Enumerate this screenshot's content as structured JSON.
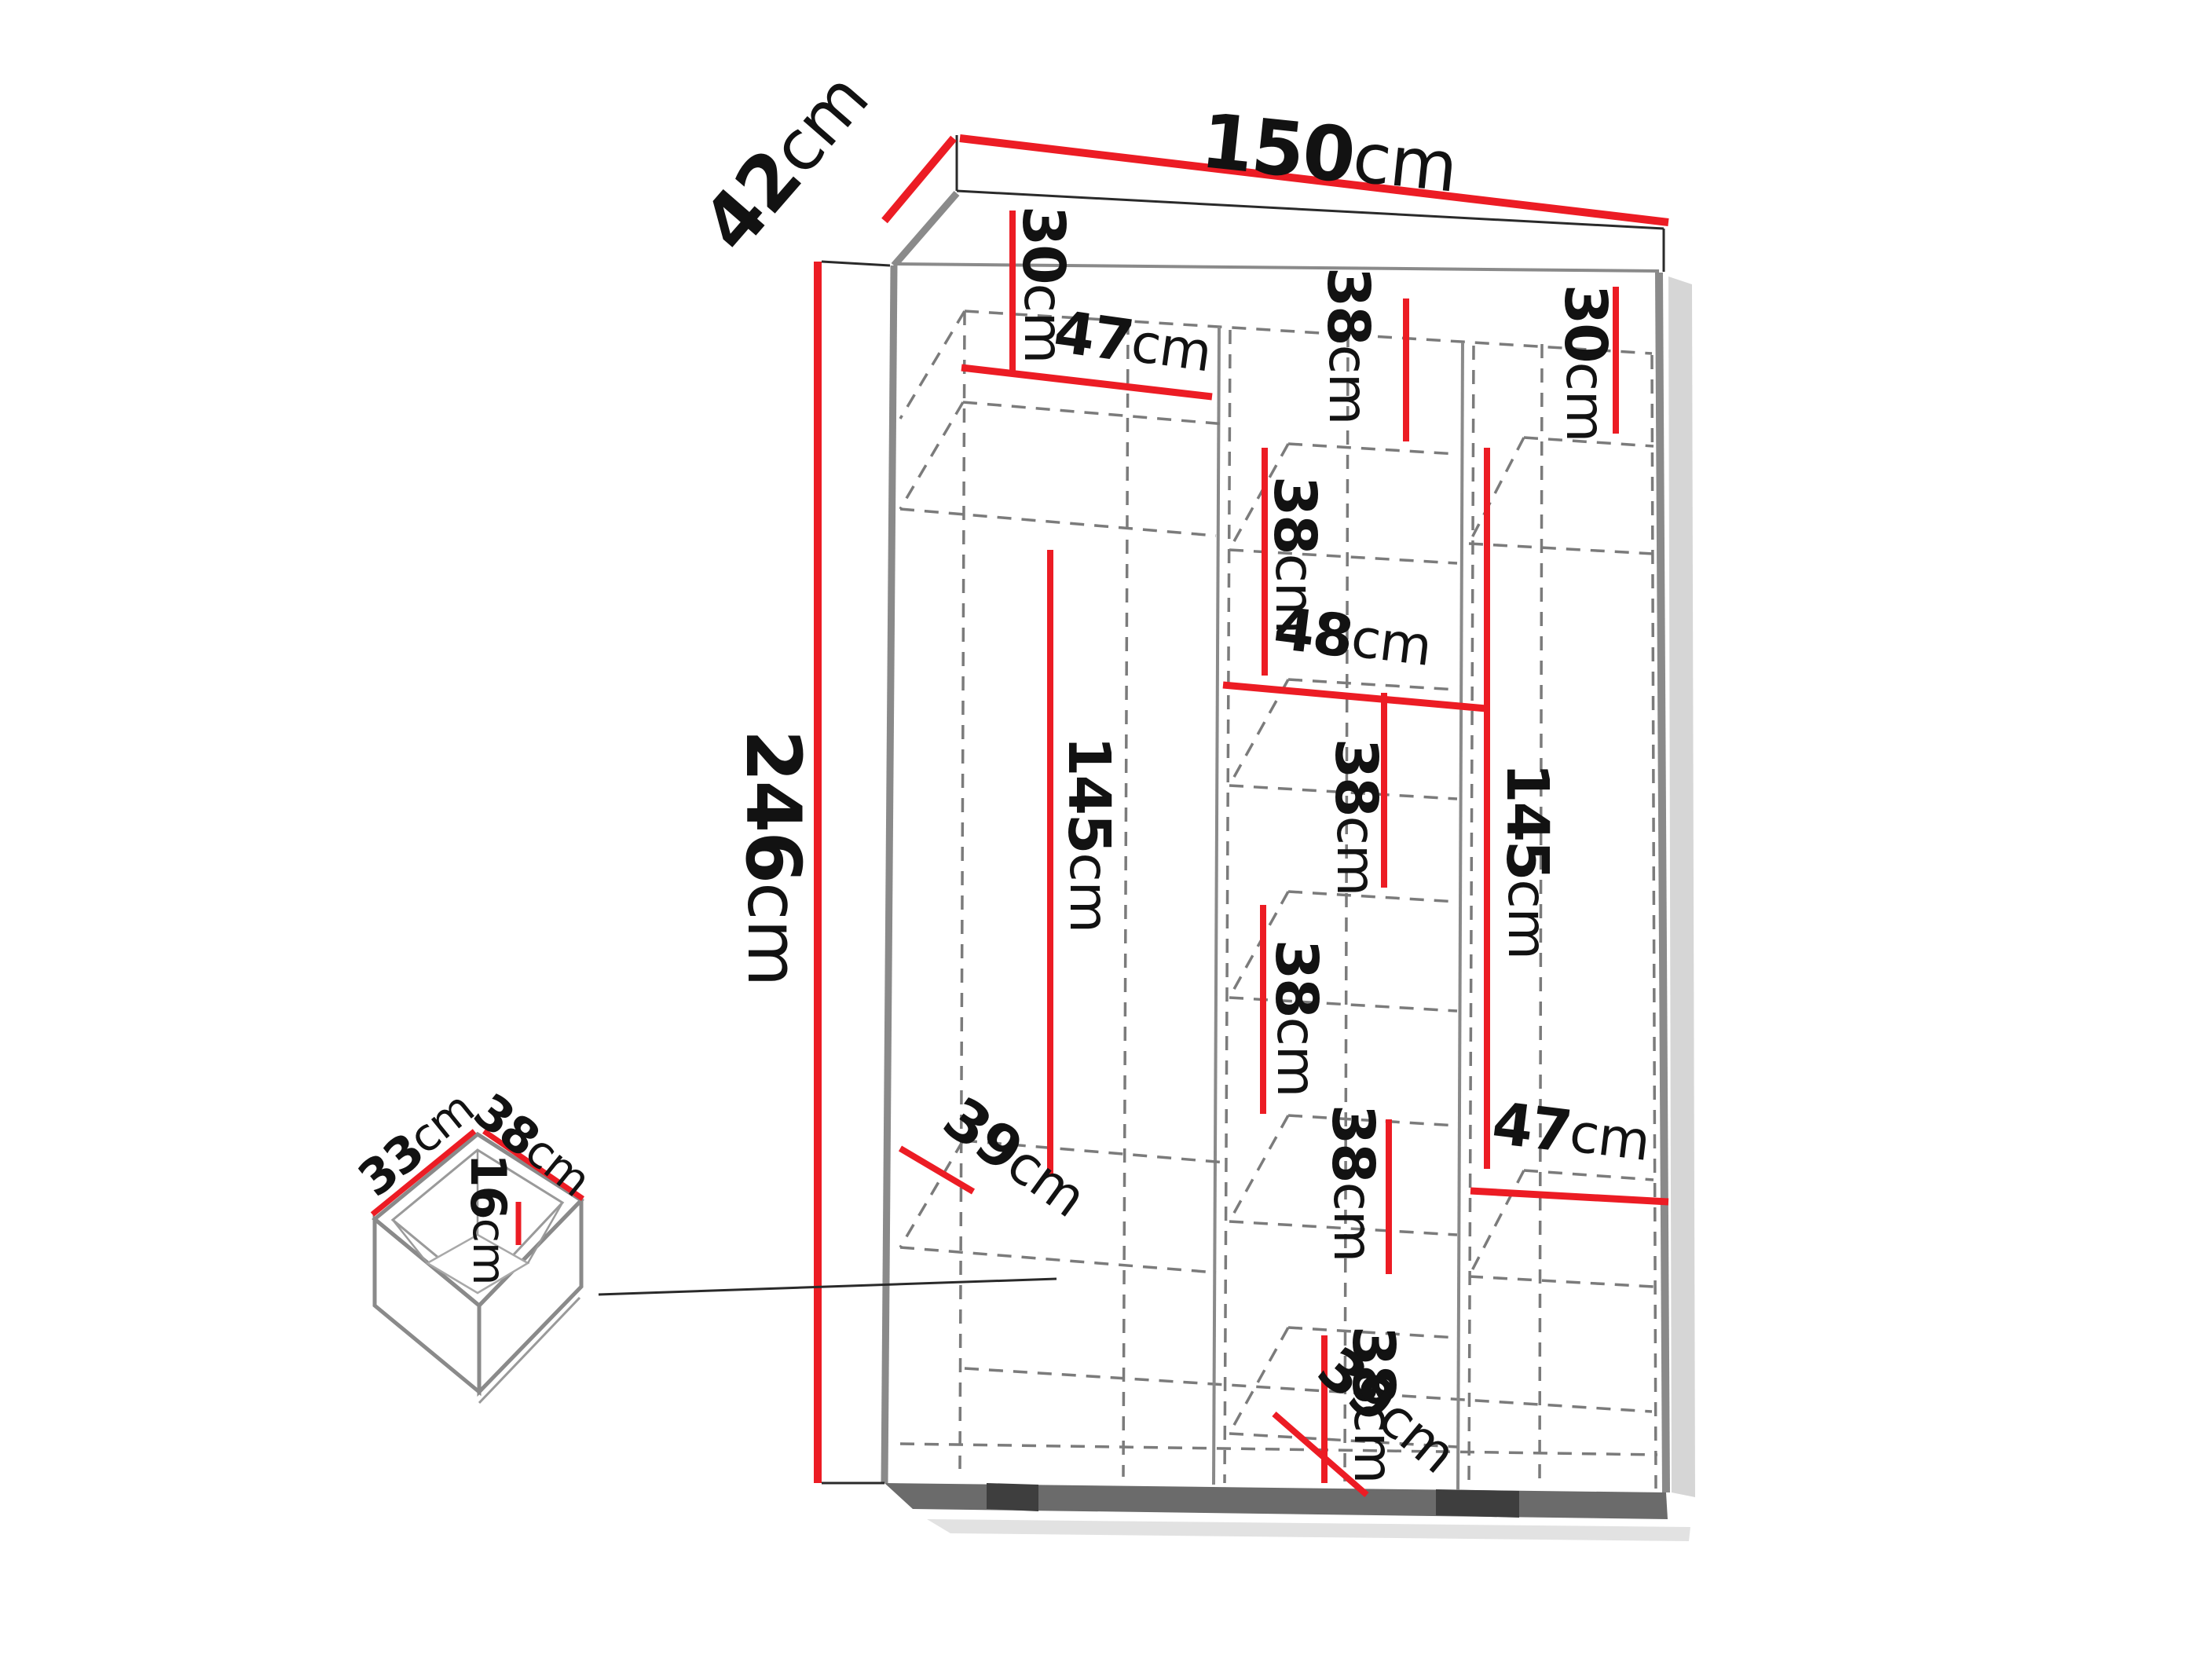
{
  "diagram": {
    "type": "furniture-dimension-diagram",
    "subject": "Three-section wardrobe wireframe with internal shelf dimensions and a detached drawer detail",
    "unit_system": "centimeters"
  },
  "colors": {
    "dimension_red": "#ec1c24",
    "structure_gray": "#8a8a8a",
    "dashed_gray": "#7b7b7b",
    "plinth_dark": "#636363",
    "text_black": "#121212",
    "background": "#ffffff"
  },
  "dims": [
    {
      "id": "top-width",
      "value": "150",
      "unit": "cm"
    },
    {
      "id": "top-depth",
      "value": "42",
      "unit": "cm"
    },
    {
      "id": "total-height",
      "value": "246",
      "unit": "cm"
    },
    {
      "id": "left-top-section-height",
      "value": "30",
      "unit": "cm"
    },
    {
      "id": "left-shelf-width",
      "value": "47",
      "unit": "cm"
    },
    {
      "id": "left-hanging-height",
      "value": "145",
      "unit": "cm"
    },
    {
      "id": "left-interior-depth",
      "value": "39",
      "unit": "cm"
    },
    {
      "id": "middle-section-1-height",
      "value": "38",
      "unit": "cm"
    },
    {
      "id": "middle-section-2-height",
      "value": "38",
      "unit": "cm"
    },
    {
      "id": "middle-shelf-width",
      "value": "48",
      "unit": "cm"
    },
    {
      "id": "middle-section-3-height",
      "value": "38",
      "unit": "cm"
    },
    {
      "id": "middle-section-4-height",
      "value": "38",
      "unit": "cm"
    },
    {
      "id": "middle-section-5-height",
      "value": "38",
      "unit": "cm"
    },
    {
      "id": "middle-section-6-height",
      "value": "38",
      "unit": "cm"
    },
    {
      "id": "middle-interior-depth",
      "value": "39",
      "unit": "cm"
    },
    {
      "id": "right-top-section-height",
      "value": "30",
      "unit": "cm"
    },
    {
      "id": "right-hanging-height",
      "value": "145",
      "unit": "cm"
    },
    {
      "id": "right-shelf-width",
      "value": "47",
      "unit": "cm"
    },
    {
      "id": "drawer-width",
      "value": "33",
      "unit": "cm"
    },
    {
      "id": "drawer-depth",
      "value": "38",
      "unit": "cm"
    },
    {
      "id": "drawer-height",
      "value": "16",
      "unit": "cm"
    }
  ]
}
